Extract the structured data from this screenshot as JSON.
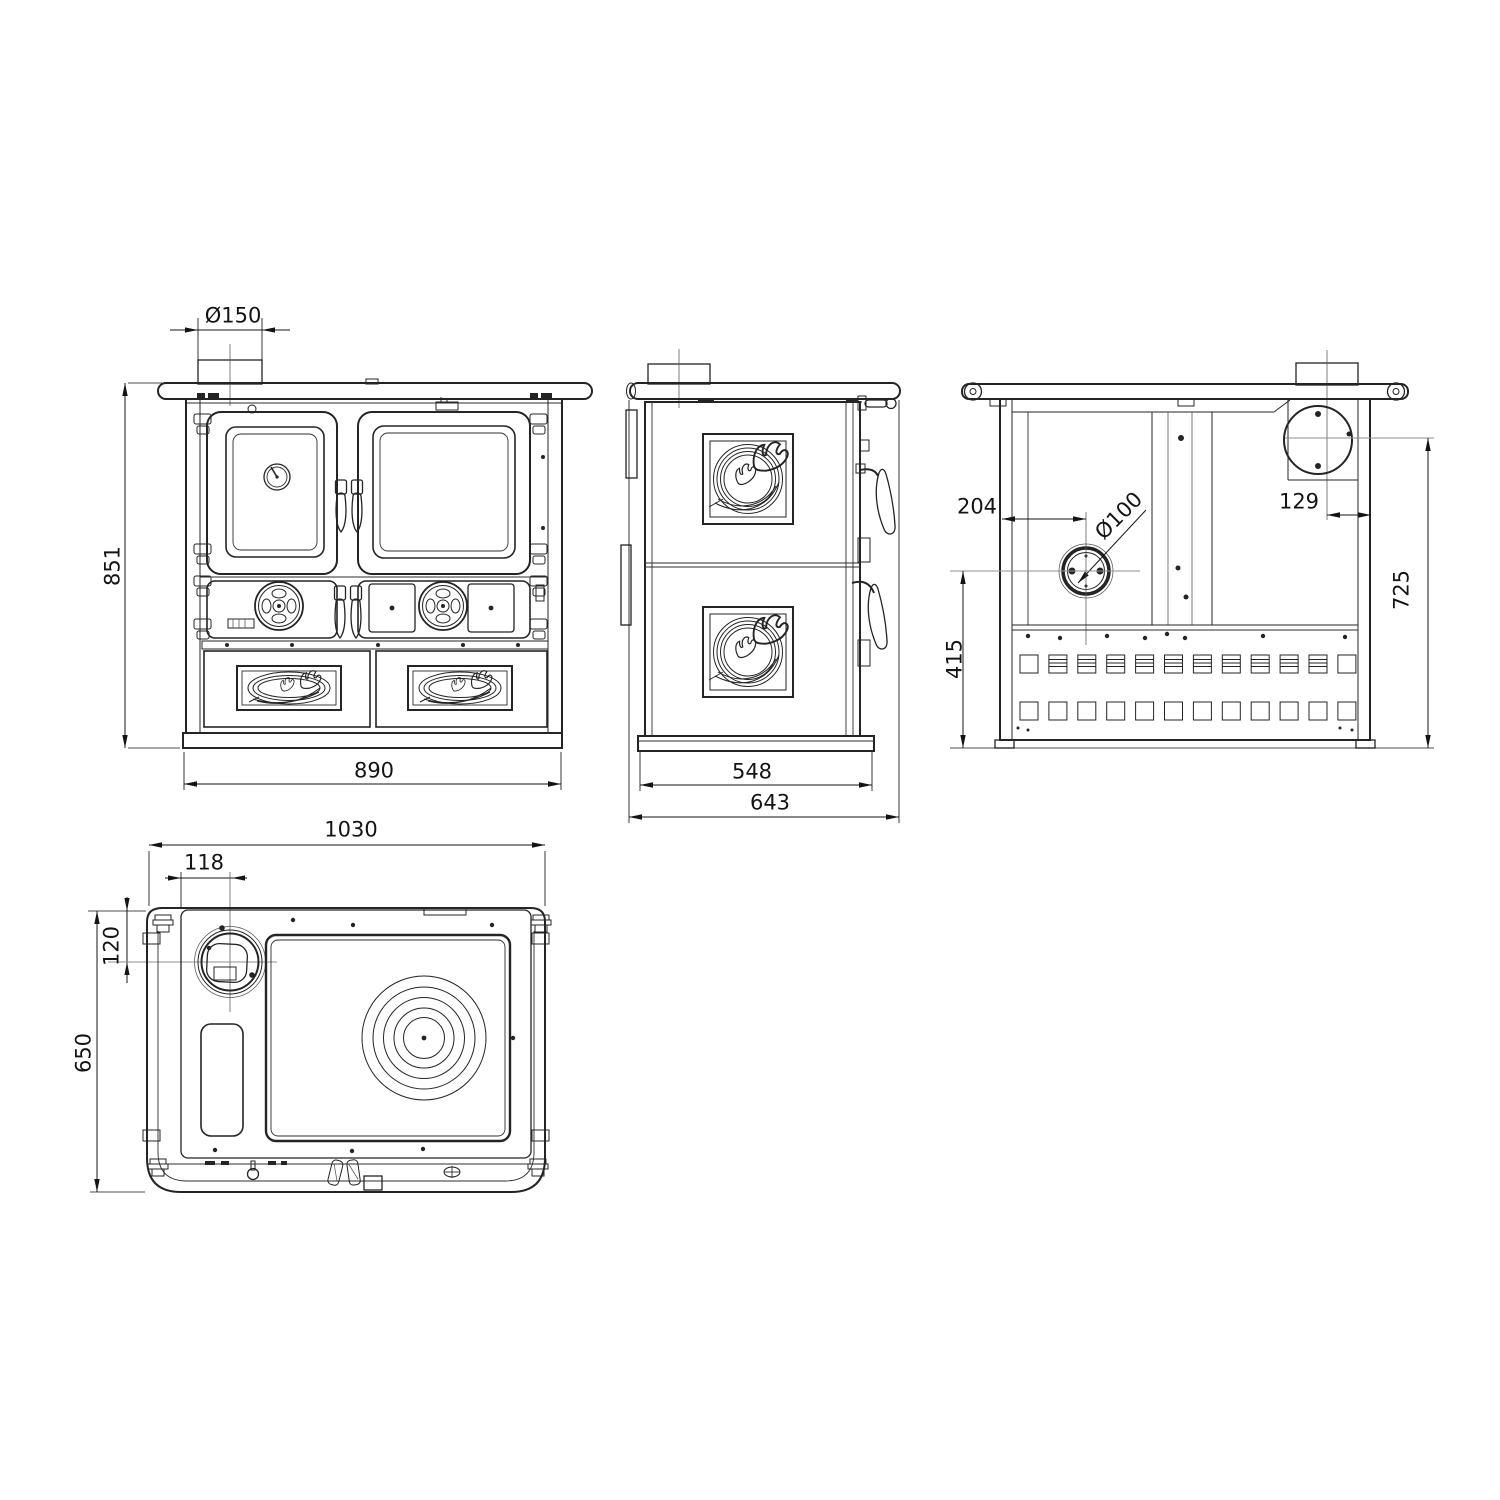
{
  "views": {
    "front": {
      "dimensions": {
        "flue_diameter": "Ø150",
        "overall_height": "851",
        "overall_width": "890"
      }
    },
    "side": {
      "dimensions": {
        "body_depth": "548",
        "overall_depth": "643"
      }
    },
    "rear": {
      "dimensions": {
        "outlet_offset_x": "204",
        "outlet_diameter": "Ø100",
        "flue_offset_x": "129",
        "flue_center_height": "725",
        "outlet_center_height": "415"
      }
    },
    "top": {
      "dimensions": {
        "overall_width": "1030",
        "flue_offset_x": "118",
        "flue_offset_y": "120",
        "overall_depth": "650"
      }
    }
  }
}
